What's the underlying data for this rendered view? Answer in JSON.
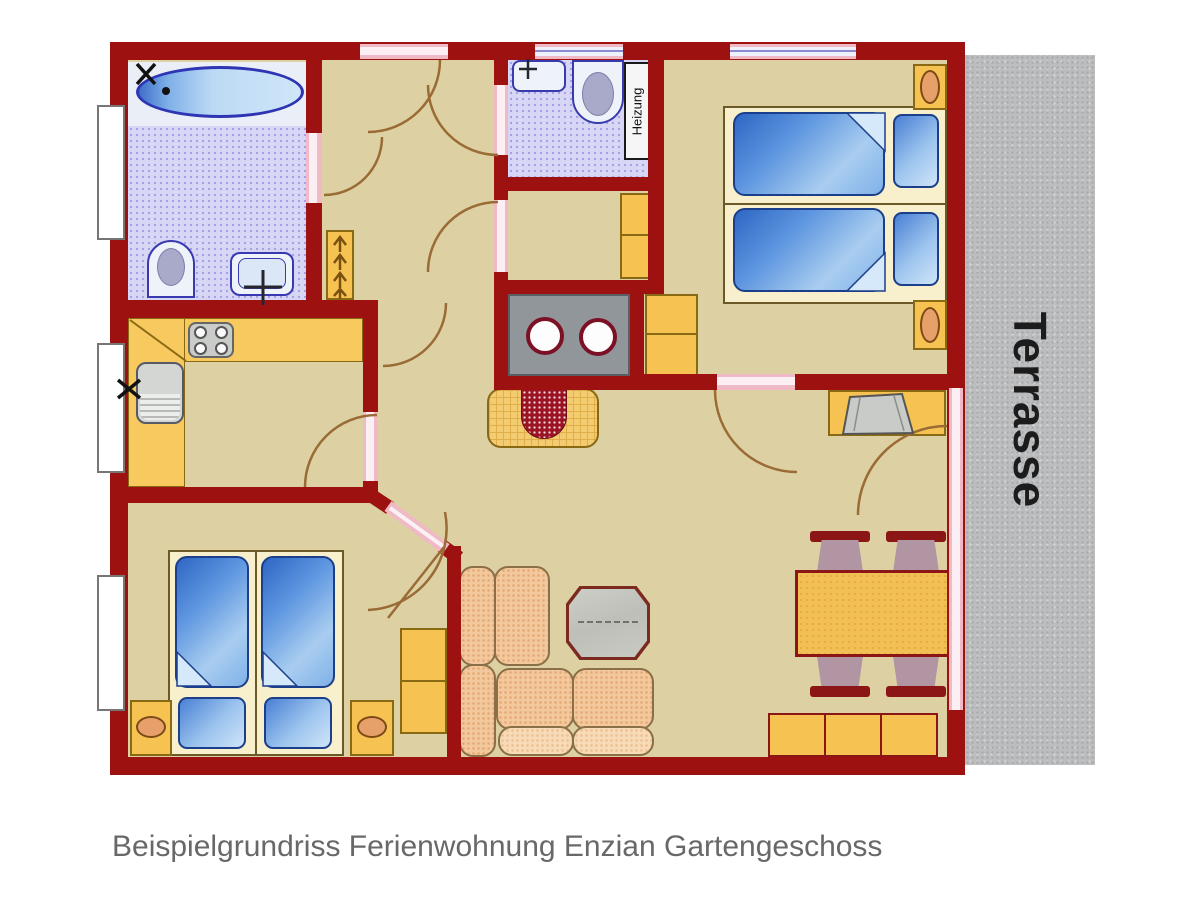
{
  "floor_plan": {
    "caption": "Beispielgrundriss Ferienwohnung Enzian Gartengeschoss",
    "labels": {
      "heating_room": "Heizung",
      "terrace": "Terrasse"
    },
    "colors": {
      "wall": "#9e1111",
      "floor": "#ddd1a3",
      "bath_tile": "#d8d6f5",
      "furniture_orange": "#f6c352",
      "bed_blue": "#4a80d4",
      "sofa_peach": "#f3c89c",
      "door_pink": "#efb9c6",
      "terrace_gray": "#bcbdbf",
      "fixture_outline": "#3a3ab0",
      "table_outline": "#8c1616"
    }
  }
}
